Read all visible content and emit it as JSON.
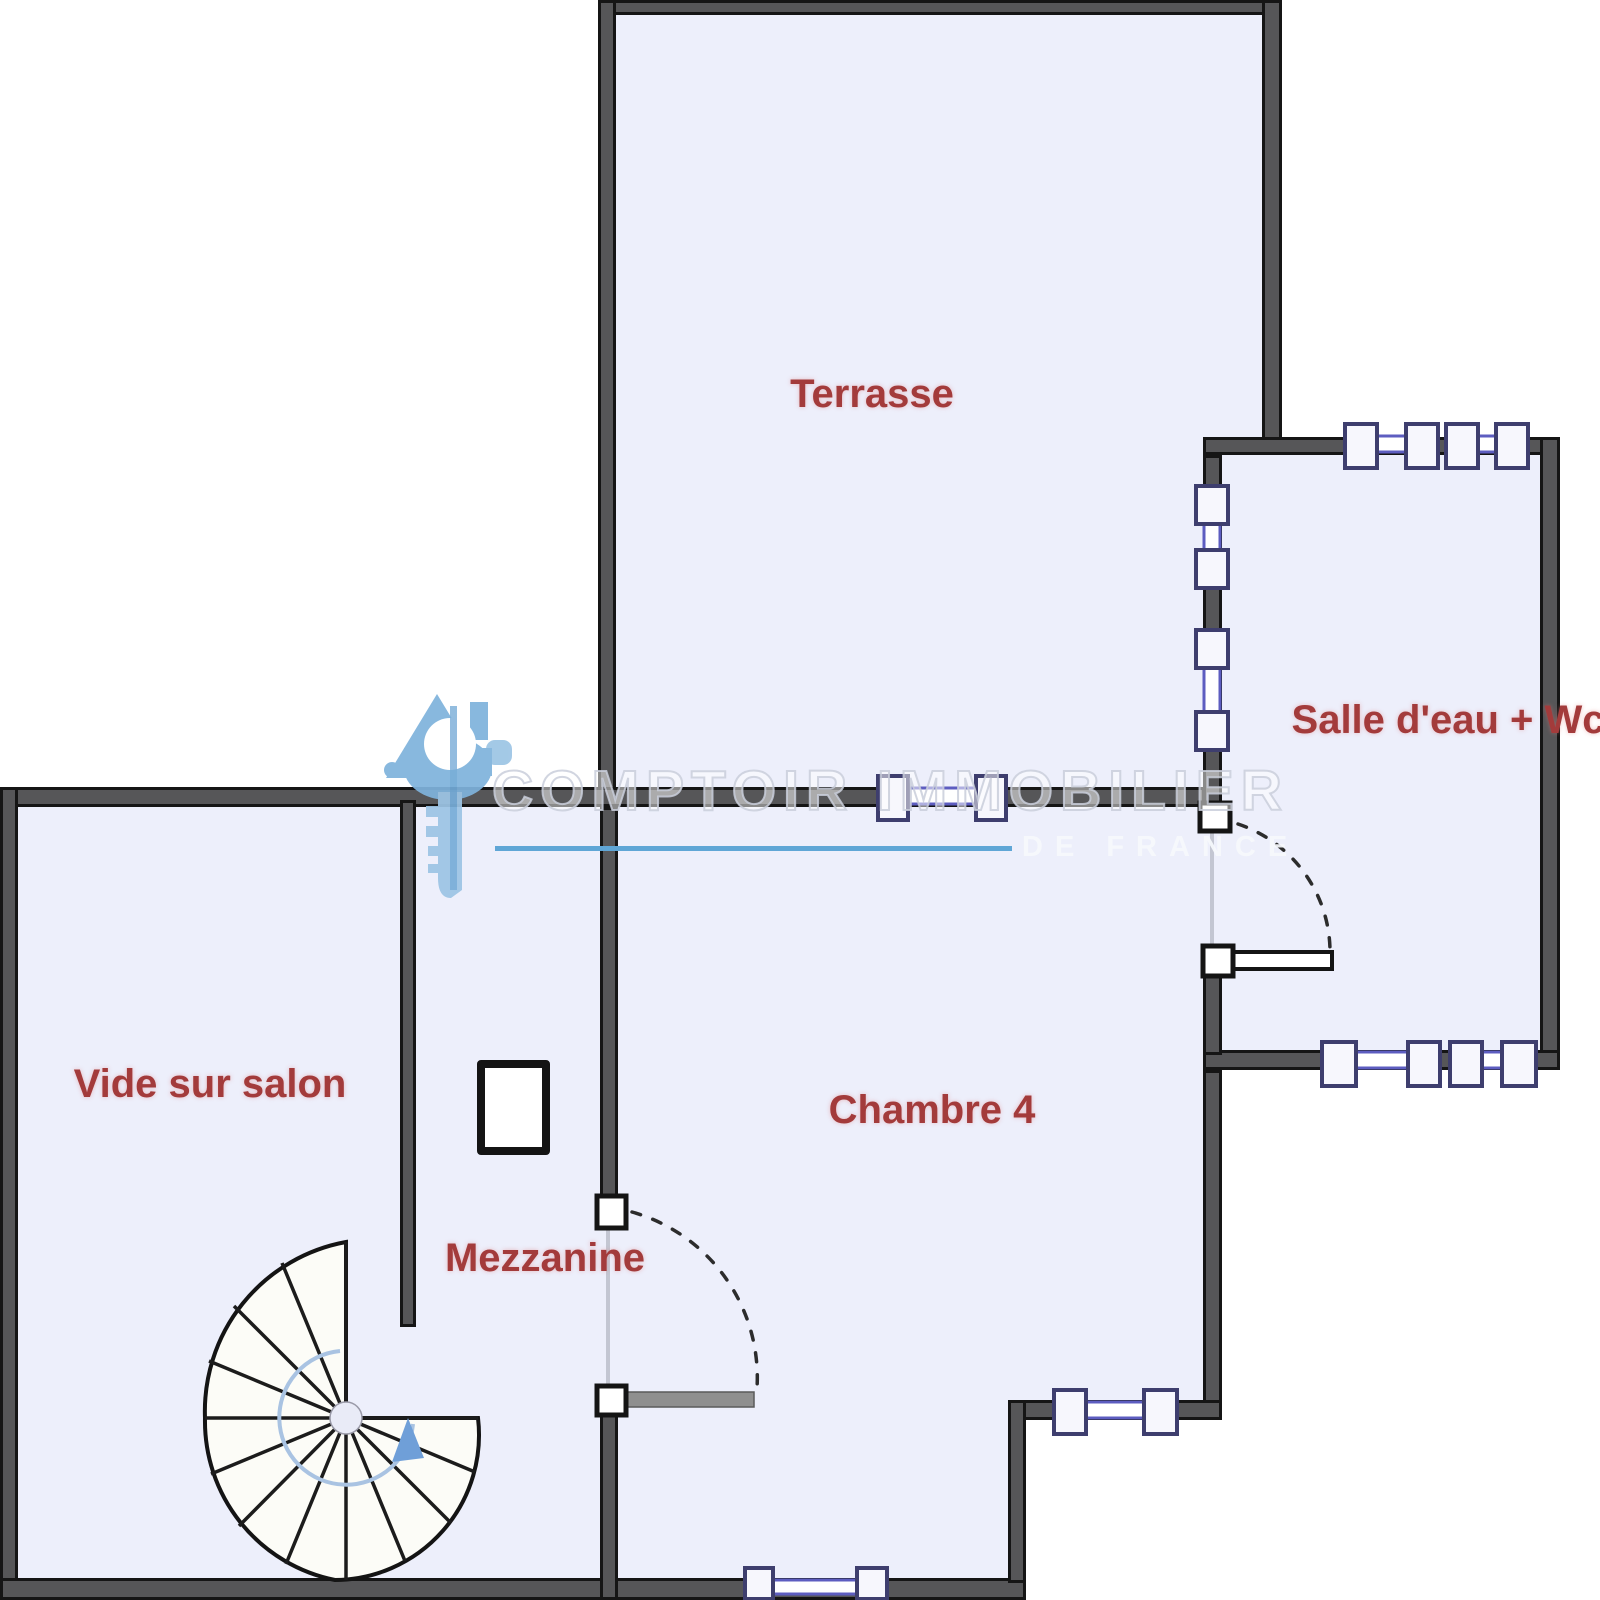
{
  "plan": {
    "rooms": {
      "terrasse": {
        "label": "Terrasse"
      },
      "salle_deau": {
        "label": "Salle d'eau + Wc"
      },
      "vide_sur_salon": {
        "label": "Vide sur salon"
      },
      "chambre_4": {
        "label": "Chambre 4"
      },
      "mezzanine": {
        "label": "Mezzanine"
      }
    }
  },
  "watermark": {
    "brand": "COMPTOIR IMMOBILIER",
    "tagline": "DE FRANCE"
  },
  "colors": {
    "room_fill": "#edeffb",
    "wall_gray": "#565658",
    "wall_edge": "#151515",
    "label_red": "#a33b3b",
    "window_frame": "#3e3e6e",
    "window_glass_blue": "#5d5dc0",
    "watermark_line_blue": "#5fa6d6",
    "logo_blue": "#7fb3dc",
    "logo_blue_light": "#9dc5e5",
    "stair_arrow_blue": "#6f9fd8"
  }
}
